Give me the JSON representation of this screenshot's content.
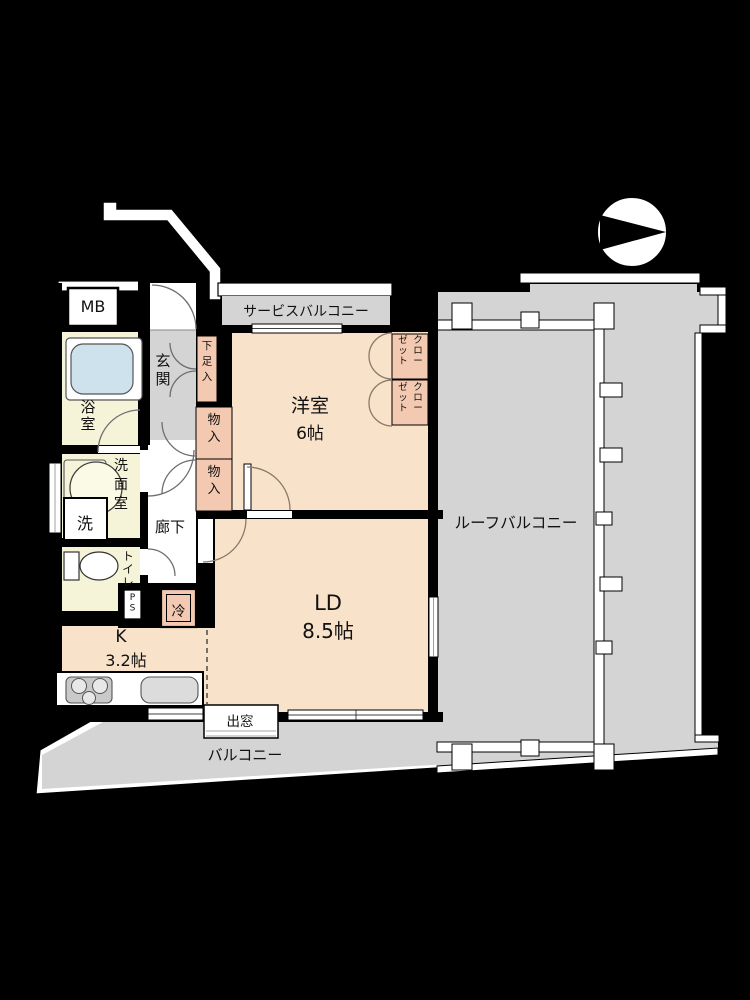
{
  "title": "floor-plan",
  "colors": {
    "background": "#000000",
    "room": "#f8e2ca",
    "wet": "#f5f4d8",
    "closet": "#f3c9b1",
    "balcony": "#d4d4d4",
    "tub": "#cde2ed",
    "wall": "#000000",
    "counter": "#ffffff",
    "appliance": "#c9c9c9"
  },
  "compass": {
    "icon": "north-arrow-circle"
  },
  "labels": {
    "mb": "MB",
    "service_balcony": "サービスバルコニー",
    "entrance": "玄関",
    "shoe_box": "下足入",
    "western_room": "洋室",
    "western_room_size": "6帖",
    "closet_col_right": "クロー",
    "closet_col_left": "ゼット",
    "bathroom": "浴室",
    "washroom": "洗面室",
    "washer": "洗",
    "toilet": "トイレ",
    "corridor": "廊下",
    "storage": "物入",
    "pipe_space": "PS",
    "refrigerator": "冷",
    "kitchen": "K",
    "kitchen_size": "3.2帖",
    "living_dining": "LD",
    "living_dining_size": "8.5帖",
    "bay_window": "出窓",
    "balcony": "バルコニー",
    "roof_balcony": "ルーフバルコニー"
  }
}
